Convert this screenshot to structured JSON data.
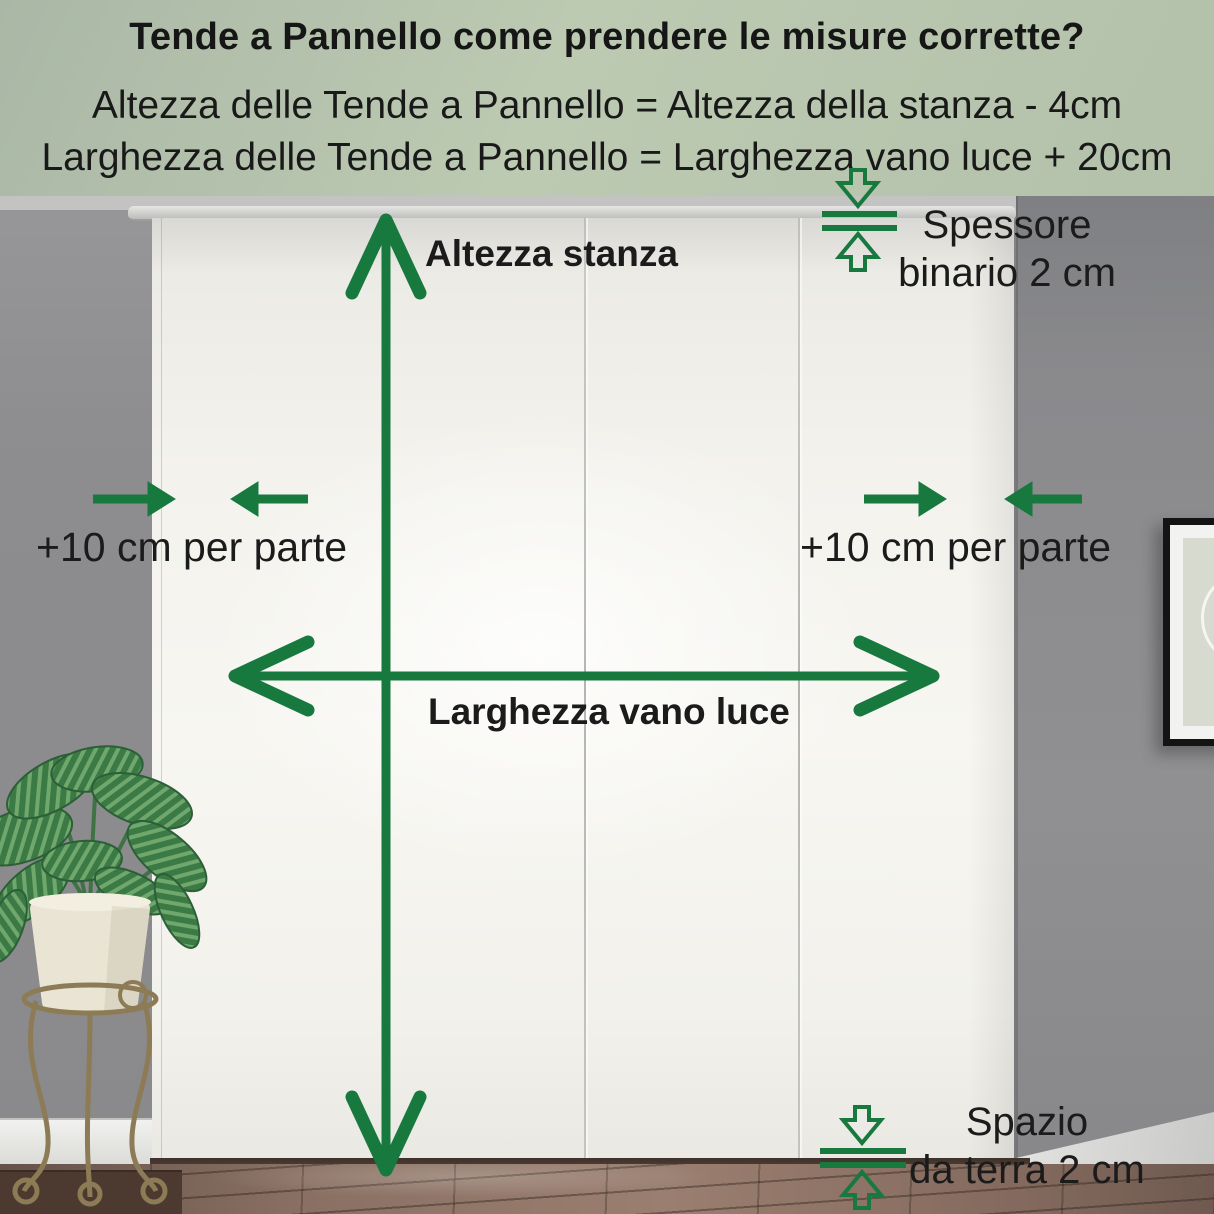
{
  "header": {
    "title": "Tende a Pannello come prendere le misure corrette?",
    "formula_height": "Altezza delle Tende a Pannello = Altezza della stanza - 4cm",
    "formula_width": "Larghezza delle Tende a Pannello = Larghezza vano luce + 20cm"
  },
  "measurements": {
    "room_height": {
      "label": "Altezza stanza"
    },
    "opening_width": {
      "label": "Larghezza vano luce"
    },
    "side_allowance_left": {
      "label": "+10 cm per parte"
    },
    "side_allowance_right": {
      "label": "+10 cm per parte"
    },
    "rail_thickness": {
      "line1": "Spessore",
      "line2": "binario 2 cm"
    },
    "floor_gap": {
      "line1": "Spazio",
      "line2": "da terra 2 cm"
    }
  },
  "colors": {
    "accent_green": "#17793e",
    "header_background": "#b6c3ac",
    "text": "#1b1b1b",
    "curtain_white": "#f4f3ee",
    "wall_gray": "#8b8b8d",
    "floor_brown": "#8a7063"
  }
}
